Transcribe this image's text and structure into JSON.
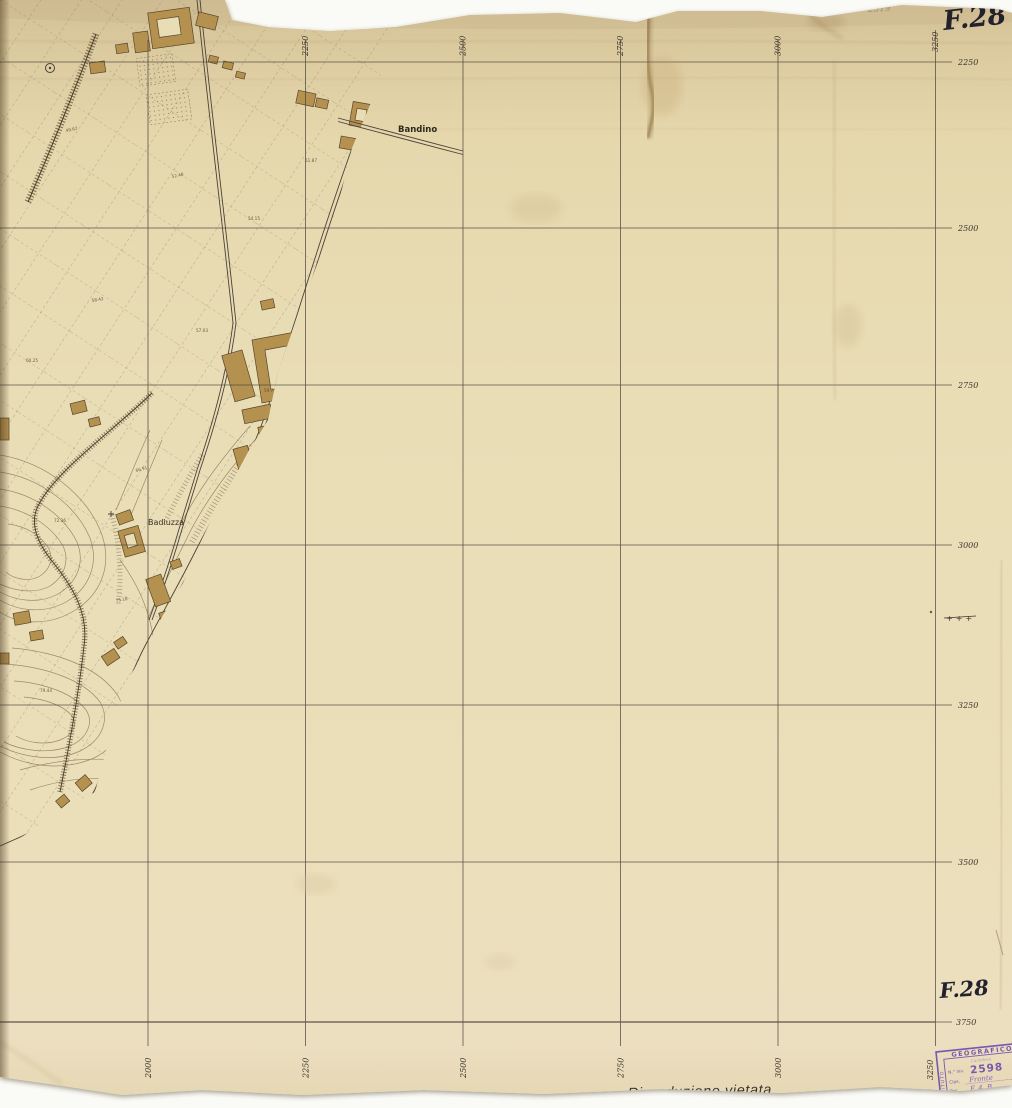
{
  "sheet": {
    "sheet_number_top": "F.28",
    "sheet_number_bottom": "F.28",
    "pencil_note": "2519",
    "reproduction_notice": "Riproduzione vietata",
    "cross_marks": "+++"
  },
  "grid": {
    "top_labels": [
      "2250",
      "2500",
      "2750",
      "3000",
      "3250"
    ],
    "bottom_labels": [
      "2000",
      "2250",
      "2500",
      "2750",
      "3000",
      "3250"
    ],
    "right_labels": [
      "2250",
      "2500",
      "2750",
      "3000",
      "3250",
      "3500",
      "3750"
    ]
  },
  "map": {
    "place_labels": [
      "Bandino",
      "Badiuzza",
      "i Moccoli"
    ],
    "road_label": "Via del Ponte a Ema",
    "spot_heights": [
      "49.62",
      "52.48",
      "54.15",
      "51.87",
      "58.42",
      "57.03",
      "60.25",
      "66.91",
      "72.36",
      "75.18",
      "79.44",
      "81.07",
      "63.58",
      "59.73"
    ]
  },
  "stamp": {
    "institute": "ISTITUTO",
    "geografico": "GEOGRAFICO",
    "militare": "MILITARE",
    "cartoteca": "Cartoteca",
    "inv_label": "N.° inv.",
    "inv_number": "2598",
    "clas_label": "Clas.",
    "clas_value": "Fronte",
    "pos_label": "Pos.",
    "pos_value": "F. 4. B.",
    "color": "#6b4fae"
  },
  "colors": {
    "paper": "#e9ddb6",
    "paper_top_band": "#d6c59e",
    "grid_line": "#4e463c",
    "building_fill": "#b5914f",
    "map_line": "#4a4238",
    "stamp_purple": "#6b4fae"
  }
}
